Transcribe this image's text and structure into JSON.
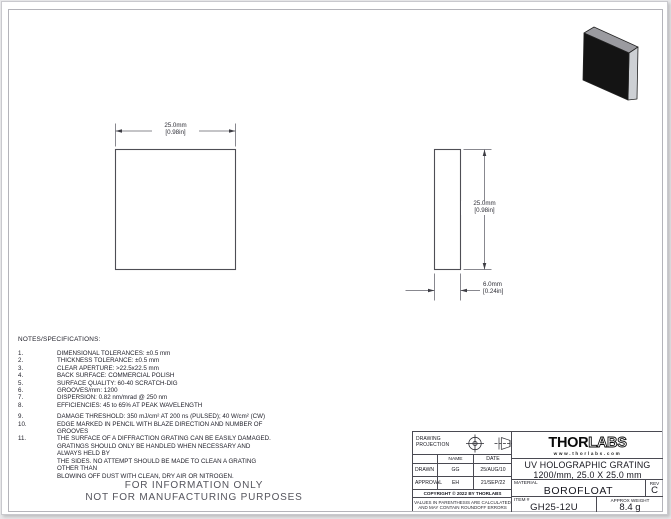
{
  "colors": {
    "line": "#4e4e55",
    "slab_front": "#141414",
    "slab_top": "#9b9ba0",
    "slab_side": "#cdd0d4"
  },
  "dimensions": {
    "front_width": {
      "mm": "25.0mm",
      "in": "[0.98in]"
    },
    "side_height": {
      "mm": "25.0mm",
      "in": "[0.98in]"
    },
    "side_thickness": {
      "mm": "6.0mm",
      "in": "[0.24in]"
    }
  },
  "notes": {
    "heading": "NOTES/SPECIFICATIONS:",
    "items": [
      {
        "num": "1.",
        "text": "DIMENSIONAL TOLERANCES: ±0.5 mm"
      },
      {
        "num": "2.",
        "text": "THICKNESS TOLERANCE: ±0.5 mm"
      },
      {
        "num": "3.",
        "text": "CLEAR APERTURE: >22.5x22.5 mm"
      },
      {
        "num": "4.",
        "text": "BACK SURFACE: COMMERCIAL POLISH"
      },
      {
        "num": "5.",
        "text": "SURFACE QUALITY: 60-40 SCRATCH-DIG"
      },
      {
        "num": "6.",
        "text": "GROOVES/mm: 1200"
      },
      {
        "num": "7.",
        "text": "DISPERSION: 0.82 nm/mrad @ 250 nm"
      },
      {
        "num": "8.",
        "text": "EFFICIENCIES: 45 to 65% AT PEAK WAVELENGTH"
      },
      {
        "num": "9.",
        "text": "DAMAGE THRESHOLD: 350 mJ/cm² AT 200 ns (PULSED); 40 W/cm² (CW)"
      },
      {
        "num": "10.",
        "text": "EDGE MARKED IN PENCIL WITH BLAZE DIRECTION AND NUMBER OF GROOVES"
      },
      {
        "num": "11.",
        "text": "THE SURFACE OF A DIFFRACTION GRATING CAN BE EASILY DAMAGED.\nGRATINGS SHOULD ONLY BE HANDLED WHEN NECESSARY AND ALWAYS HELD BY\nTHE SIDES. NO ATTEMPT SHOULD BE MADE TO CLEAN A GRATING OTHER THAN\nBLOWING OFF DUST WITH CLEAN, DRY AIR OR NITROGEN."
      }
    ]
  },
  "watermark": {
    "line1": "FOR INFORMATION ONLY",
    "line2": "NOT FOR MANUFACTURING PURPOSES"
  },
  "title_block": {
    "projection_label": "DRAWING PROJECTION",
    "table": {
      "name_header": "NAME",
      "date_header": "DATE",
      "drawn_label": "DRAWN",
      "drawn_name": "GG",
      "drawn_date": "25/AUG/10",
      "approval_label": "APPROVAL",
      "approval_name": "EH",
      "approval_date": "21/SEP/22"
    },
    "copyright": "COPYRIGHT © 2022 BY THORLABS",
    "disclaimer": "VALUES IN PARENTHESIS ARE CALCULATED\nAND MAY CONTAIN ROUNDOFF ERRORS",
    "logo": {
      "thor": "THOR",
      "labs": "LABS",
      "url": "www.thorlabs.com"
    },
    "title_line1": "UV HOLOGRAPHIC GRATING",
    "title_line2": "1200/mm, 25.0 X 25.0 mm",
    "material_label": "MATERIAL",
    "material_value": "BOROFLOAT",
    "rev_label": "REV",
    "rev_value": "C",
    "item_label": "ITEM #",
    "item_value": "GH25-12U",
    "weight_label": "APPROX WEIGHT",
    "weight_value": "8.4 g"
  }
}
